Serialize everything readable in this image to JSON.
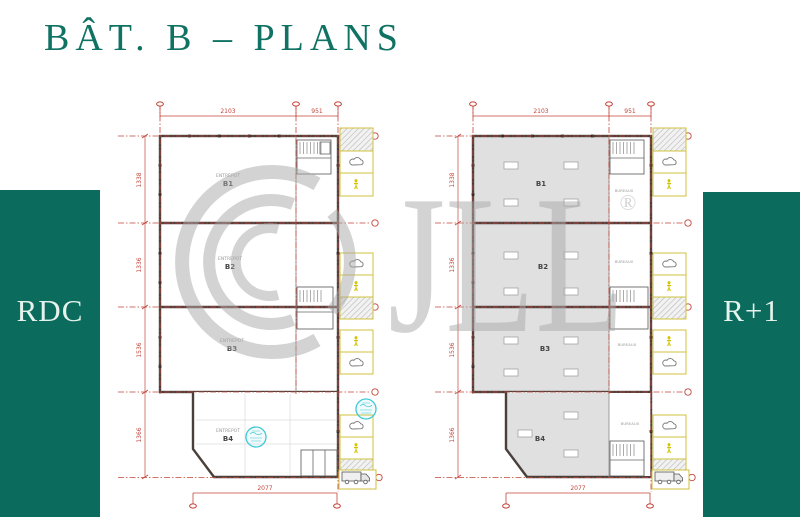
{
  "title": "BÂT. B – PLANS",
  "panels": {
    "left": "RDC",
    "right": "R+1"
  },
  "watermark": {
    "letters": "JLL",
    "registered": "®"
  },
  "plans": [
    {
      "name": "rdc",
      "dims": {
        "top": [
          "2103",
          "951"
        ],
        "left": [
          "1338",
          "1336",
          "1536",
          "1366"
        ],
        "bottom": "2077"
      },
      "sections": [
        {
          "label": "B1",
          "sub": "ENTREPOT"
        },
        {
          "label": "B2",
          "sub": "ENTREPOT"
        },
        {
          "label": "B3",
          "sub": "ENTREPOT"
        },
        {
          "label": "B4",
          "sub": "ENTREPOT"
        }
      ]
    },
    {
      "name": "r1",
      "dims": {
        "top": [
          "2103",
          "951"
        ],
        "left": [
          "1338",
          "1336",
          "1536",
          "1366"
        ],
        "bottom": "2077"
      },
      "sections": [
        {
          "label": "B1"
        },
        {
          "label": "B2"
        },
        {
          "label": "B3"
        },
        {
          "label": "B4"
        }
      ],
      "strip_labels": [
        "BUREAUX",
        "BUREAUX",
        "BUREAUX",
        "BUREAUX"
      ]
    }
  ],
  "icons": {
    "cloud": "cloud-icon",
    "accessible": "accessibility-icon",
    "truck": "truck-icon",
    "stamp": "approval-stamp-icon",
    "marker": "survey-marker-icon"
  },
  "colors": {
    "brand_green": "#0b6b5c",
    "title_green": "#0f7263",
    "dimension_red": "#c4453a",
    "annotation_yellow": "#cfc23e",
    "stamp_cyan": "#3ec8d8",
    "watermark_gray": "#a9a9a9",
    "wall_dark": "#4a403b",
    "floor_gray": "#e0e0e0"
  }
}
